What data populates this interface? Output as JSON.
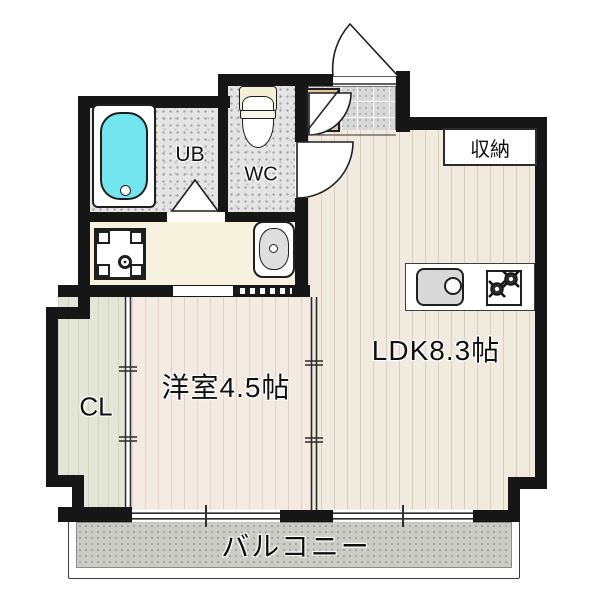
{
  "rooms": {
    "unit_bath": {
      "label": "UB"
    },
    "toilet": {
      "label": "WC"
    },
    "storage": {
      "label": "収納"
    },
    "ldk": {
      "label": "LDK8.3帖"
    },
    "western_room": {
      "label": "洋室4.5帖"
    },
    "closet": {
      "label": "CL"
    },
    "balcony": {
      "label": "バルコニー"
    }
  },
  "colors": {
    "wall": "#161616",
    "bathtub": "#72e5ee",
    "wood_ldk": "#f1eadf",
    "wood_west": "#f3eae2",
    "closet_floor": "#e3e6d6",
    "washroom_floor": "#f6f2dd",
    "tile_entry": "#d8d8d8",
    "balcony_floor": "#cbccc6",
    "shoe_cabinet": "#e3c79e"
  }
}
